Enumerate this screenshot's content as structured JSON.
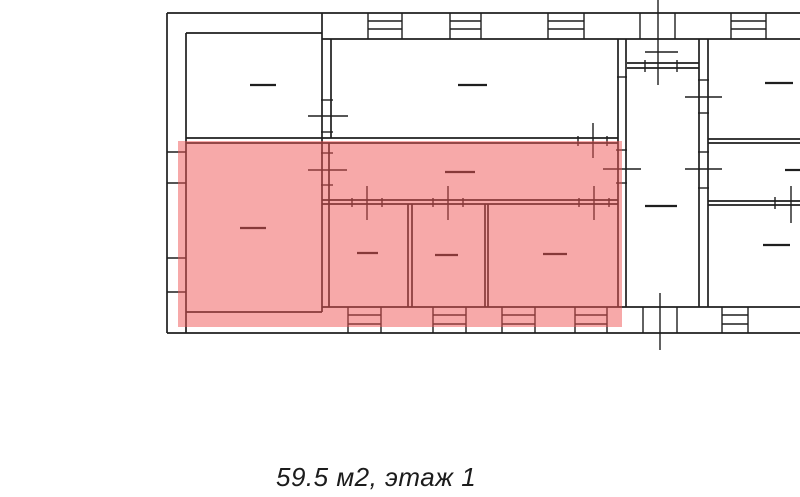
{
  "caption": {
    "text": "59.5 м2, этаж 1"
  },
  "colors": {
    "wall_line": "#1f1f1f",
    "highlight": "rgba(239,83,83,0.5)",
    "background": "#ffffff"
  },
  "floor_plan": {
    "canvas": {
      "width": 800,
      "height": 497
    },
    "highlight_rect": {
      "x": 178,
      "y": 141,
      "width": 444,
      "height": 186
    },
    "groups": {
      "walls": {
        "stroke_width": 1.7,
        "lines": [
          [
            167,
            13,
            800,
            13
          ],
          [
            167,
            13,
            167,
            333
          ],
          [
            167,
            333,
            800,
            333
          ],
          [
            186,
            33,
            186,
            333
          ],
          [
            186,
            33,
            322,
            33
          ],
          [
            322,
            39,
            800,
            39
          ],
          [
            186,
            312,
            322,
            312
          ],
          [
            322,
            307,
            800,
            307
          ],
          [
            322,
            13,
            322,
            312
          ],
          [
            331,
            39,
            331,
            138
          ],
          [
            329,
            143,
            329,
            307
          ],
          [
            618,
            39,
            618,
            307
          ],
          [
            626,
            39,
            626,
            307
          ],
          [
            699,
            39,
            699,
            307
          ],
          [
            708,
            39,
            708,
            307
          ],
          [
            186,
            138,
            618,
            138
          ],
          [
            186,
            143,
            618,
            143
          ],
          [
            322,
            200,
            618,
            200
          ],
          [
            322,
            204,
            618,
            204
          ],
          [
            408,
            204,
            408,
            307
          ],
          [
            412,
            204,
            412,
            307
          ],
          [
            485,
            204,
            485,
            307
          ],
          [
            488,
            204,
            488,
            307
          ],
          [
            627,
            63,
            699,
            63
          ],
          [
            627,
            68,
            699,
            68
          ],
          [
            708,
            139,
            800,
            139
          ],
          [
            708,
            143,
            800,
            143
          ],
          [
            708,
            201,
            800,
            201
          ],
          [
            708,
            205,
            800,
            205
          ]
        ]
      },
      "windows": {
        "stroke_width": 1.4,
        "lines": [
          [
            368,
            13,
            368,
            39
          ],
          [
            402,
            13,
            402,
            39
          ],
          [
            368,
            21,
            402,
            21
          ],
          [
            368,
            29,
            402,
            29
          ],
          [
            450,
            13,
            450,
            39
          ],
          [
            481,
            13,
            481,
            39
          ],
          [
            450,
            21,
            481,
            21
          ],
          [
            450,
            29,
            481,
            29
          ],
          [
            548,
            13,
            548,
            39
          ],
          [
            584,
            13,
            584,
            39
          ],
          [
            548,
            21,
            584,
            21
          ],
          [
            548,
            29,
            584,
            29
          ],
          [
            640,
            13,
            640,
            39
          ],
          [
            675,
            13,
            675,
            39
          ],
          [
            731,
            13,
            731,
            39
          ],
          [
            766,
            13,
            766,
            39
          ],
          [
            731,
            21,
            766,
            21
          ],
          [
            731,
            29,
            766,
            29
          ],
          [
            348,
            307,
            348,
            333
          ],
          [
            381,
            307,
            381,
            333
          ],
          [
            348,
            315,
            381,
            315
          ],
          [
            348,
            324,
            381,
            324
          ],
          [
            433,
            307,
            433,
            333
          ],
          [
            466,
            307,
            466,
            333
          ],
          [
            433,
            315,
            466,
            315
          ],
          [
            433,
            324,
            466,
            324
          ],
          [
            502,
            307,
            502,
            333
          ],
          [
            535,
            307,
            535,
            333
          ],
          [
            502,
            315,
            535,
            315
          ],
          [
            502,
            324,
            535,
            324
          ],
          [
            575,
            307,
            575,
            333
          ],
          [
            607,
            307,
            607,
            333
          ],
          [
            575,
            315,
            607,
            315
          ],
          [
            575,
            324,
            607,
            324
          ],
          [
            722,
            307,
            722,
            333
          ],
          [
            748,
            307,
            748,
            333
          ],
          [
            722,
            315,
            748,
            315
          ],
          [
            722,
            324,
            748,
            324
          ],
          [
            643,
            307,
            643,
            333
          ],
          [
            677,
            307,
            677,
            333
          ],
          [
            167,
            152,
            186,
            152
          ],
          [
            167,
            183,
            186,
            183
          ],
          [
            167,
            258,
            186,
            258
          ],
          [
            167,
            292,
            186,
            292
          ]
        ]
      },
      "door_marks": {
        "stroke_width": 1.4,
        "lines": [
          [
            658,
            0,
            658,
            85
          ],
          [
            645,
            52,
            678,
            52
          ],
          [
            645,
            60,
            645,
            72
          ],
          [
            677,
            60,
            677,
            72
          ],
          [
            308,
            116,
            348,
            116
          ],
          [
            321,
            100,
            333,
            100
          ],
          [
            321,
            132,
            333,
            132
          ],
          [
            308,
            170,
            347,
            170
          ],
          [
            321,
            153,
            333,
            153
          ],
          [
            321,
            185,
            333,
            185
          ],
          [
            593,
            123,
            593,
            158
          ],
          [
            578,
            136,
            578,
            146
          ],
          [
            607,
            136,
            607,
            146
          ],
          [
            367,
            186,
            367,
            220
          ],
          [
            352,
            198,
            352,
            207
          ],
          [
            382,
            198,
            382,
            207
          ],
          [
            448,
            186,
            448,
            220
          ],
          [
            433,
            198,
            433,
            207
          ],
          [
            463,
            198,
            463,
            207
          ],
          [
            594,
            186,
            594,
            220
          ],
          [
            579,
            198,
            579,
            207
          ],
          [
            609,
            198,
            609,
            207
          ],
          [
            603,
            169,
            641,
            169
          ],
          [
            616,
            150,
            627,
            150
          ],
          [
            616,
            183,
            627,
            183
          ],
          [
            617,
            77,
            627,
            77
          ],
          [
            685,
            97,
            722,
            97
          ],
          [
            698,
            80,
            709,
            80
          ],
          [
            698,
            113,
            709,
            113
          ],
          [
            685,
            169,
            722,
            169
          ],
          [
            698,
            152,
            709,
            152
          ],
          [
            698,
            188,
            709,
            188
          ],
          [
            791,
            186,
            791,
            223
          ],
          [
            775,
            197,
            775,
            209
          ],
          [
            660,
            293,
            660,
            350
          ]
        ]
      },
      "room_dashes": {
        "stroke_width": 2.2,
        "lines": [
          [
            250,
            85,
            276,
            85
          ],
          [
            458,
            85,
            487,
            85
          ],
          [
            765,
            83,
            793,
            83
          ],
          [
            785,
            170,
            800,
            170
          ],
          [
            763,
            245,
            790,
            245
          ],
          [
            645,
            206,
            677,
            206
          ],
          [
            240,
            228,
            266,
            228
          ],
          [
            445,
            172,
            475,
            172
          ],
          [
            357,
            253,
            378,
            253
          ],
          [
            435,
            255,
            458,
            255
          ],
          [
            543,
            254,
            567,
            254
          ]
        ]
      }
    }
  }
}
